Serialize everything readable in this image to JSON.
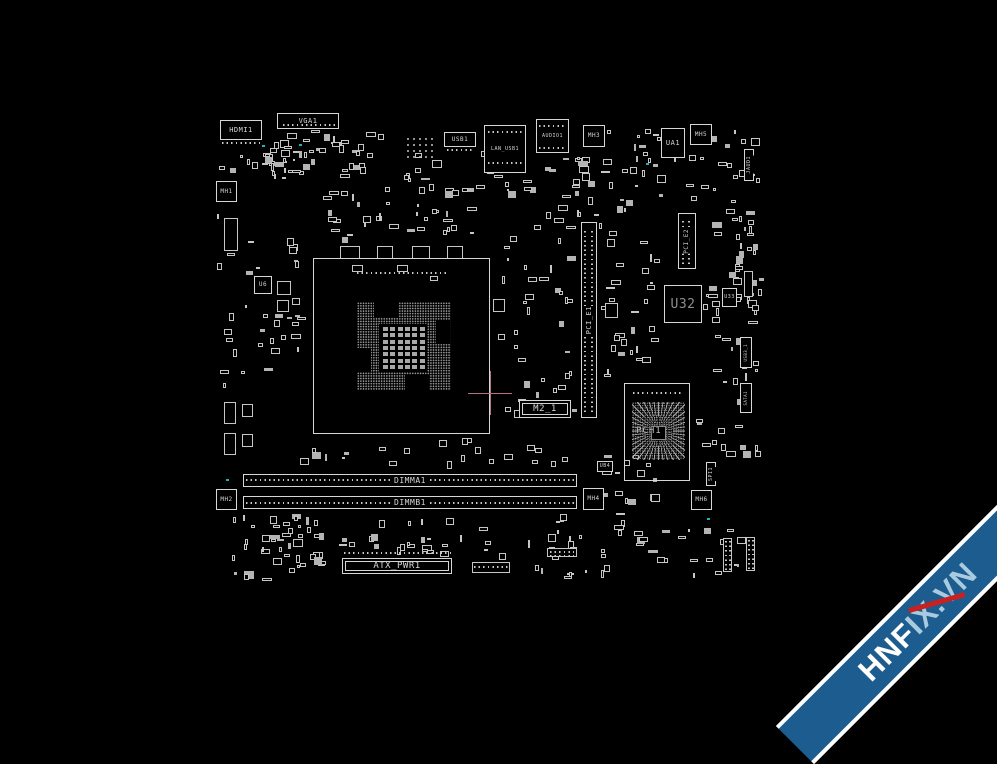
{
  "watermark": {
    "part1": "HNF",
    "part2": "IX.VN",
    "ribbon_color": "#1d5c8e",
    "band_edge_color": "#ffffff",
    "part1_color": "#ffffff",
    "part2_color": "#a9cbe0",
    "slash_color": "#c92121"
  },
  "colors": {
    "background": "#000000",
    "line": "#d6d6d6",
    "dim_line": "#969696",
    "crosshair": "#b5737f",
    "cyan_marker": "#1ab6b6"
  },
  "crosshair": {
    "x": 490,
    "y": 393,
    "arm": 22
  },
  "components": [
    {
      "name": "hdmi1-connector",
      "label": "HDMI1",
      "x": 220,
      "y": 120,
      "w": 42,
      "h": 20,
      "kind": "io",
      "fs": 7
    },
    {
      "name": "vga1-connector",
      "label": "VGA1",
      "x": 277,
      "y": 113,
      "w": 62,
      "h": 16,
      "kind": "io",
      "fs": 7
    },
    {
      "name": "usb1-connector",
      "label": "USB1",
      "x": 444,
      "y": 132,
      "w": 32,
      "h": 15,
      "kind": "io",
      "fs": 6
    },
    {
      "name": "lan-usb1-connector",
      "label": "LAN_USB1",
      "x": 484,
      "y": 125,
      "w": 42,
      "h": 48,
      "kind": "io",
      "fs": 5
    },
    {
      "name": "audio1-connector",
      "label": "AUDIO1",
      "x": 536,
      "y": 119,
      "w": 33,
      "h": 34,
      "kind": "io",
      "fs": 5
    },
    {
      "name": "mounting-hole-mh1",
      "label": "MH1",
      "x": 216,
      "y": 181,
      "w": 21,
      "h": 21,
      "kind": "mh",
      "fs": 6
    },
    {
      "name": "mounting-hole-mh2",
      "label": "MH2",
      "x": 216,
      "y": 489,
      "w": 21,
      "h": 21,
      "kind": "mh",
      "fs": 6
    },
    {
      "name": "mounting-hole-mh3",
      "label": "MH3",
      "x": 583,
      "y": 125,
      "w": 22,
      "h": 22,
      "kind": "mh",
      "fs": 6
    },
    {
      "name": "mounting-hole-mh4",
      "label": "MH4",
      "x": 583,
      "y": 488,
      "w": 21,
      "h": 22,
      "kind": "mh",
      "fs": 6
    },
    {
      "name": "mounting-hole-mh5",
      "label": "MH5",
      "x": 690,
      "y": 124,
      "w": 22,
      "h": 21,
      "kind": "mh",
      "fs": 6
    },
    {
      "name": "mounting-hole-mh6",
      "label": "MH6",
      "x": 691,
      "y": 490,
      "w": 21,
      "h": 20,
      "kind": "mh",
      "fs": 6
    },
    {
      "name": "chip-ua1",
      "label": "UA1",
      "x": 661,
      "y": 128,
      "w": 24,
      "h": 30,
      "kind": "chip",
      "fs": 7
    },
    {
      "name": "chip-u6",
      "label": "U6",
      "x": 254,
      "y": 276,
      "w": 18,
      "h": 18,
      "kind": "chip",
      "fs": 6
    },
    {
      "name": "chip-u32",
      "label": "U32",
      "x": 664,
      "y": 285,
      "w": 38,
      "h": 38,
      "kind": "chip",
      "fs": 13,
      "lc": "#8e8e8e"
    },
    {
      "name": "chip-u33",
      "label": "U33",
      "x": 722,
      "y": 288,
      "w": 15,
      "h": 19,
      "kind": "chip",
      "fs": 5
    },
    {
      "name": "chip-ub4",
      "label": "UB4",
      "x": 597,
      "y": 461,
      "w": 16,
      "h": 11,
      "kind": "chip",
      "fs": 5
    },
    {
      "name": "pci-e1-slot",
      "label": "PCI_E1",
      "x": 581,
      "y": 222,
      "w": 16,
      "h": 196,
      "kind": "slotv",
      "fs": 7
    },
    {
      "name": "pci-e2-slot",
      "label": "PCI_E2",
      "x": 678,
      "y": 213,
      "w": 18,
      "h": 56,
      "kind": "slotv",
      "fs": 6
    },
    {
      "name": "m2-1-connector",
      "label": "M2_1",
      "x": 519,
      "y": 400,
      "w": 52,
      "h": 18,
      "kind": "connh",
      "fs": 9
    },
    {
      "name": "dimma1-slot",
      "label": "DIMMA1",
      "x": 243,
      "y": 474,
      "w": 334,
      "h": 13,
      "kind": "sloth",
      "fs": 8
    },
    {
      "name": "dimmb1-slot",
      "label": "DIMMB1",
      "x": 243,
      "y": 496,
      "w": 334,
      "h": 13,
      "kind": "sloth",
      "fs": 8
    },
    {
      "name": "atx-pwr1-connector",
      "label": "ATX_PWR1",
      "x": 342,
      "y": 558,
      "w": 110,
      "h": 16,
      "kind": "connh",
      "fs": 9
    },
    {
      "name": "jaud1-header",
      "label": "JAUD1",
      "x": 744,
      "y": 149,
      "w": 10,
      "h": 32,
      "kind": "connv",
      "fs": 5
    },
    {
      "name": "spi1-header",
      "label": "SPI1",
      "x": 706,
      "y": 462,
      "w": 10,
      "h": 24,
      "kind": "connv",
      "fs": 5
    },
    {
      "name": "usb3-1-header",
      "label": "USB3_1",
      "x": 740,
      "y": 337,
      "w": 12,
      "h": 31,
      "kind": "connv",
      "fs": 4
    },
    {
      "name": "sata1-header",
      "label": "SATA1",
      "x": 740,
      "y": 383,
      "w": 12,
      "h": 30,
      "kind": "connv",
      "fs": 4
    },
    {
      "name": "cpu-socket",
      "label": "",
      "x": 313,
      "y": 258,
      "w": 177,
      "h": 176,
      "kind": "socket",
      "fs": 6
    },
    {
      "name": "pch1-bga",
      "label": "PCH1",
      "x": 624,
      "y": 383,
      "w": 66,
      "h": 98,
      "kind": "bga",
      "fs": 9
    }
  ],
  "dotrows": [
    [
      222,
      142,
      40,
      2,
      "h"
    ],
    [
      283,
      124,
      52,
      2,
      "h"
    ],
    [
      447,
      149,
      26,
      2,
      "h"
    ],
    [
      488,
      131,
      34,
      2,
      "h"
    ],
    [
      488,
      162,
      34,
      2,
      "h"
    ],
    [
      405,
      136,
      30,
      22,
      "grid"
    ],
    [
      539,
      125,
      27,
      2,
      "h"
    ],
    [
      539,
      147,
      27,
      2,
      "h"
    ],
    [
      246,
      479,
      328,
      2,
      "h"
    ],
    [
      246,
      502,
      328,
      2,
      "h"
    ],
    [
      344,
      552,
      108,
      2,
      "h"
    ],
    [
      584,
      228,
      2,
      184,
      "v"
    ],
    [
      591,
      228,
      2,
      184,
      "v"
    ],
    [
      682,
      219,
      2,
      45,
      "v"
    ],
    [
      688,
      219,
      2,
      45,
      "v"
    ],
    [
      725,
      541,
      2,
      29,
      "v"
    ],
    [
      729,
      541,
      2,
      29,
      "v"
    ],
    [
      748,
      540,
      2,
      29,
      "v"
    ],
    [
      752,
      540,
      2,
      29,
      "v"
    ],
    [
      474,
      566,
      34,
      2,
      "h"
    ],
    [
      550,
      551,
      24,
      2,
      "h"
    ],
    [
      550,
      555,
      24,
      2,
      "h"
    ],
    [
      357,
      272,
      90,
      2,
      "h"
    ],
    [
      633,
      392,
      50,
      2,
      "h"
    ]
  ],
  "parts": [
    [
      224,
      218,
      14,
      33
    ],
    [
      224,
      402,
      12,
      22
    ],
    [
      224,
      433,
      12,
      22
    ],
    [
      242,
      404,
      11,
      13
    ],
    [
      242,
      434,
      11,
      13
    ],
    [
      340,
      246,
      20,
      13
    ],
    [
      377,
      246,
      16,
      13
    ],
    [
      412,
      246,
      18,
      13
    ],
    [
      447,
      246,
      16,
      13
    ],
    [
      493,
      299,
      12,
      13
    ],
    [
      605,
      303,
      13,
      15
    ],
    [
      472,
      562,
      38,
      11
    ],
    [
      547,
      548,
      30,
      9
    ],
    [
      723,
      538,
      9,
      34
    ],
    [
      746,
      537,
      9,
      34
    ],
    [
      744,
      271,
      9,
      26
    ],
    [
      352,
      265,
      11,
      7
    ],
    [
      397,
      265,
      11,
      7
    ],
    [
      430,
      276,
      8,
      5
    ],
    [
      277,
      281,
      14,
      14
    ],
    [
      277,
      300,
      12,
      12
    ]
  ],
  "clusters": [
    [
      215,
      140,
      95,
      40,
      30,
      11
    ],
    [
      278,
      128,
      120,
      55,
      32,
      22
    ],
    [
      398,
      150,
      140,
      48,
      22,
      33
    ],
    [
      318,
      183,
      160,
      60,
      36,
      44
    ],
    [
      536,
      155,
      120,
      75,
      30,
      55
    ],
    [
      600,
      128,
      160,
      80,
      36,
      66
    ],
    [
      240,
      235,
      72,
      170,
      30,
      77
    ],
    [
      494,
      222,
      86,
      200,
      38,
      88
    ],
    [
      600,
      228,
      62,
      150,
      30,
      99
    ],
    [
      700,
      208,
      60,
      125,
      26,
      110
    ],
    [
      692,
      335,
      70,
      135,
      28,
      121
    ],
    [
      300,
      437,
      280,
      32,
      22,
      132
    ],
    [
      218,
      514,
      115,
      68,
      46,
      143
    ],
    [
      333,
      518,
      190,
      42,
      26,
      154
    ],
    [
      520,
      512,
      240,
      70,
      48,
      165
    ],
    [
      735,
      210,
      30,
      120,
      14,
      176
    ],
    [
      214,
      210,
      26,
      180,
      10,
      187
    ],
    [
      598,
      453,
      64,
      60,
      14,
      198
    ]
  ],
  "cyan_dots": [
    [
      262,
      145
    ],
    [
      299,
      144
    ],
    [
      646,
      163
    ],
    [
      707,
      518
    ],
    [
      226,
      479
    ]
  ]
}
